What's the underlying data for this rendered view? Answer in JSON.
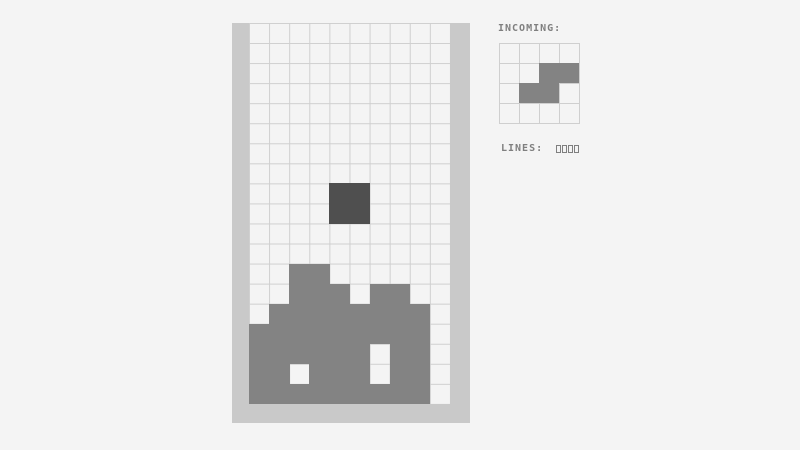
{
  "app": {
    "name": "tetris-game",
    "incoming_label": "INCOMING:",
    "lines_label": "LINES:",
    "lines_value": "0000"
  },
  "colors": {
    "background": "#f4f4f4",
    "wall": "#c9c9c9",
    "gridline": "#cfcfcf",
    "cell_fill": "#f4f4f4",
    "stack": "#838383",
    "falling_piece": "#4f4f4f",
    "text": "#7f7f7f"
  },
  "board": {
    "cols": 10,
    "rows": 19,
    "falling_piece": {
      "type": "O",
      "cells": [
        [
          8,
          4
        ],
        [
          8,
          5
        ],
        [
          9,
          4
        ],
        [
          9,
          5
        ]
      ]
    },
    "stack_cells": [
      [
        12,
        2
      ],
      [
        12,
        3
      ],
      [
        13,
        2
      ],
      [
        13,
        3
      ],
      [
        13,
        4
      ],
      [
        13,
        6
      ],
      [
        13,
        7
      ],
      [
        14,
        1
      ],
      [
        14,
        2
      ],
      [
        14,
        3
      ],
      [
        14,
        4
      ],
      [
        14,
        5
      ],
      [
        14,
        6
      ],
      [
        14,
        7
      ],
      [
        14,
        8
      ],
      [
        15,
        0
      ],
      [
        15,
        1
      ],
      [
        15,
        2
      ],
      [
        15,
        3
      ],
      [
        15,
        4
      ],
      [
        15,
        5
      ],
      [
        15,
        6
      ],
      [
        15,
        7
      ],
      [
        15,
        8
      ],
      [
        16,
        0
      ],
      [
        16,
        1
      ],
      [
        16,
        2
      ],
      [
        16,
        3
      ],
      [
        16,
        4
      ],
      [
        16,
        5
      ],
      [
        16,
        7
      ],
      [
        16,
        8
      ],
      [
        17,
        0
      ],
      [
        17,
        1
      ],
      [
        17,
        3
      ],
      [
        17,
        4
      ],
      [
        17,
        5
      ],
      [
        17,
        7
      ],
      [
        17,
        8
      ],
      [
        18,
        0
      ],
      [
        18,
        1
      ],
      [
        18,
        2
      ],
      [
        18,
        3
      ],
      [
        18,
        4
      ],
      [
        18,
        5
      ],
      [
        18,
        6
      ],
      [
        18,
        7
      ],
      [
        18,
        8
      ]
    ]
  },
  "preview": {
    "cols": 4,
    "rows": 4,
    "piece_type": "S",
    "cells": [
      [
        1,
        2
      ],
      [
        1,
        3
      ],
      [
        2,
        1
      ],
      [
        2,
        2
      ]
    ]
  }
}
